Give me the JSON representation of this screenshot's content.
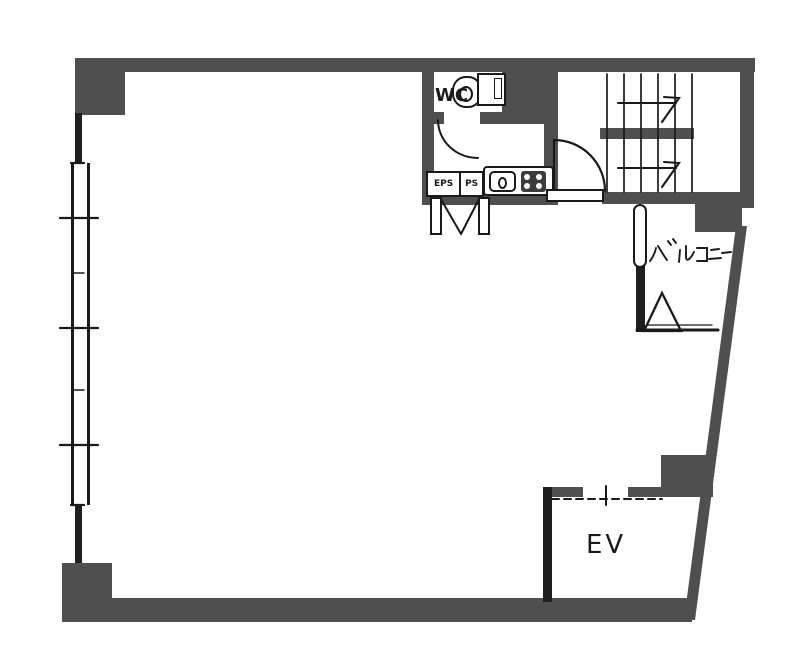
{
  "document": {
    "type": "architectural-floor-plan",
    "background": "#ffffff"
  },
  "colors": {
    "wall_fill": "#4f4f4f",
    "line": "#1a1a1a",
    "room_fill": "#ffffff"
  },
  "rooms": {
    "wc": {
      "label": "WC"
    },
    "pipe_shafts": {
      "eps_label": "EPS",
      "ps_label": "PS"
    },
    "balcony": {
      "label": "バルコニー"
    },
    "elevator": {
      "label": "EV"
    }
  },
  "symbols": {
    "toilet": "toilet-top-view",
    "kitchen_sink": "counter-sink-basin",
    "stove": "burner-stove",
    "stairs": "treads-with-up-arrows",
    "escape_hatch": "triangle-hatch",
    "elevator_door": "dashed-opening",
    "doors": "quarter-circle-swing",
    "windows": "double-line-glazing"
  }
}
